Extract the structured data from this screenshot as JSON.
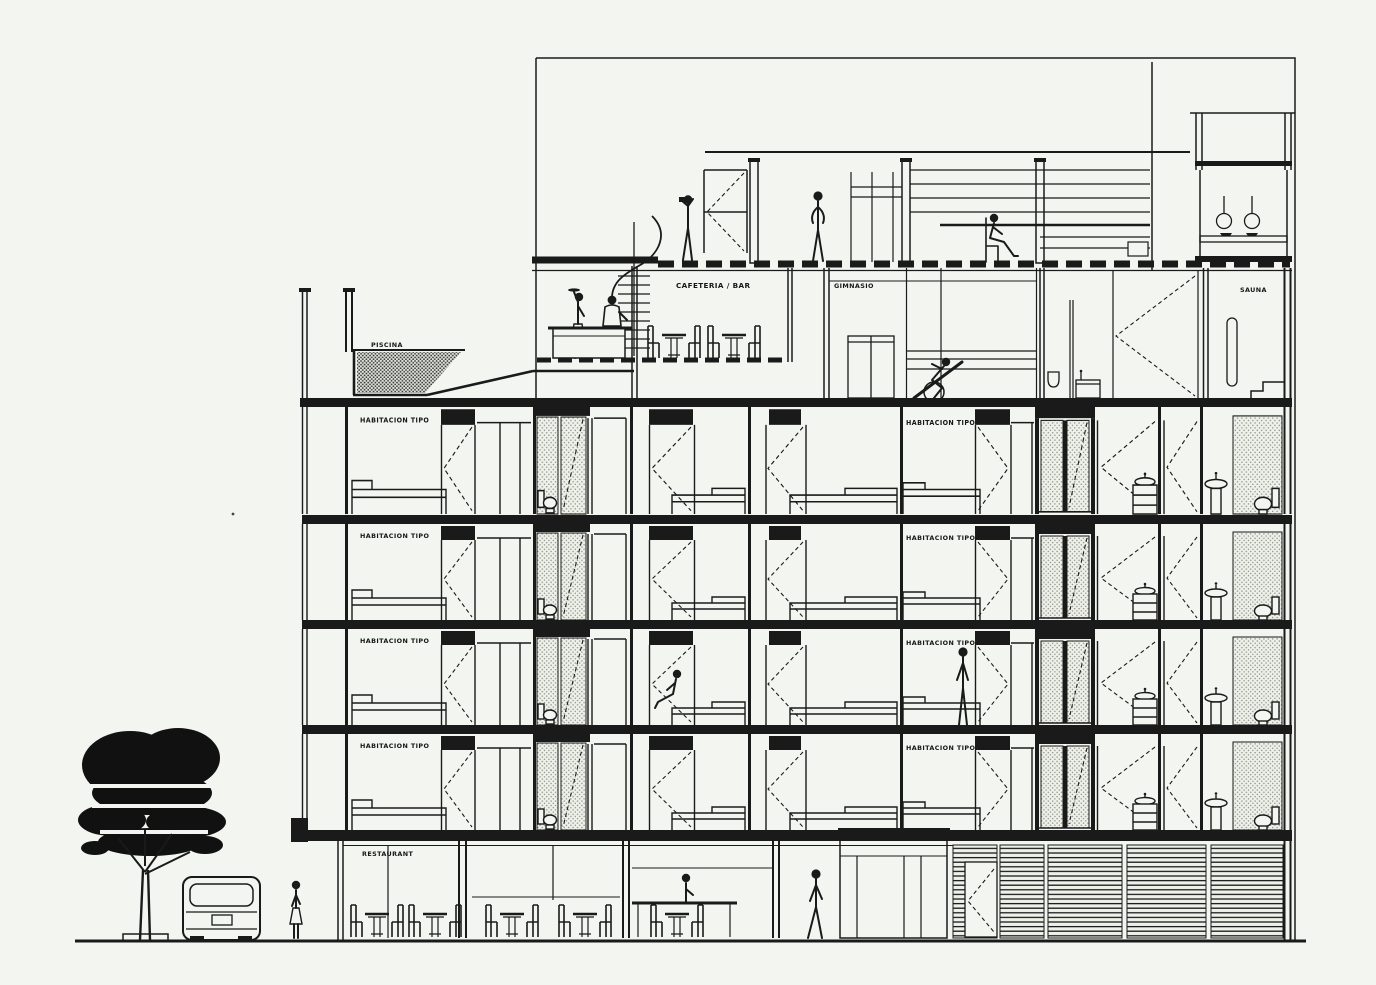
{
  "drawing": {
    "kind": "architectural-cross-section",
    "subject": "hotel building section with street, tree and van",
    "paper_color": "#f3f6f0",
    "ink_color": "#1a1a1a",
    "hatch_color": "#5a5a5a"
  },
  "labels": {
    "piscina": "PISCINA",
    "cafeteria_bar": "CAFETERIA / BAR",
    "gimnasio": "GIMNASIO",
    "sauna": "SAUNA",
    "habitacion_tipo": "HABITACION TIPO",
    "restaurant": "RESTAURANT"
  },
  "label_instances": {
    "habitacion_tipo_left_column": 4,
    "habitacion_tipo_right_column": 4,
    "guest_floors": 4
  },
  "scene": {
    "amenities_level_rooms": [
      "PISCINA",
      "CAFETERIA / BAR",
      "GIMNASIO",
      "SAUNA"
    ],
    "ground_level_rooms": [
      "RESTAURANT"
    ],
    "people_count": 11,
    "tree": true,
    "van": true
  }
}
